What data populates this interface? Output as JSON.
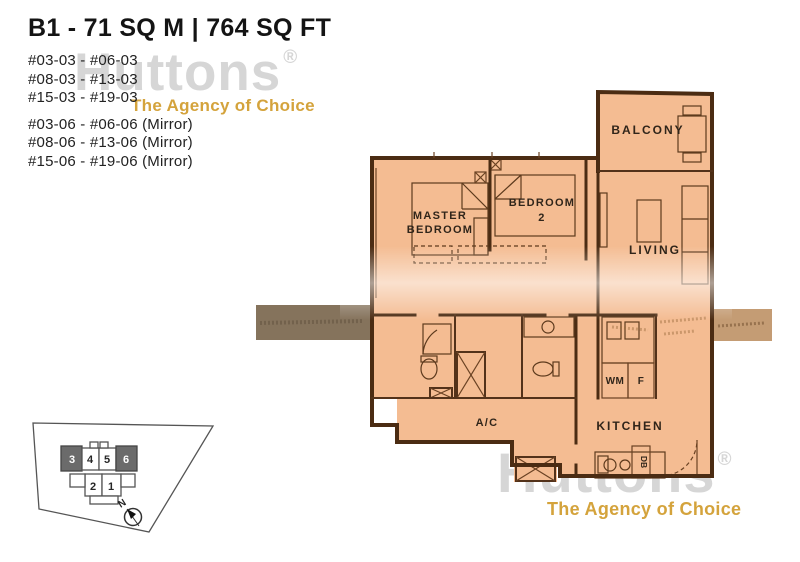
{
  "header": {
    "title": "B1 - 71 SQ M | 764 SQ FT",
    "stack_03_lines": [
      "#03-03 - #06-03",
      "#08-03 - #13-03",
      "#15-03 - #19-03"
    ],
    "stack_06_lines": [
      "#03-06 - #06-06 (Mirror)",
      "#08-06 - #13-06 (Mirror)",
      "#15-06 - #19-06 (Mirror)"
    ]
  },
  "watermark": {
    "brand": "Huttons",
    "registered": "®",
    "tagline": "The Agency of Choice",
    "gray": "#d6d6d6",
    "gold": "#d4a33c"
  },
  "floorplan": {
    "rooms": {
      "balcony": "BALCONY",
      "living": "LIVING",
      "master_line1": "MASTER",
      "master_line2": "BEDROOM",
      "bedroom2_line1": "BEDROOM",
      "bedroom2_line2": "2",
      "ac": "A/C",
      "kitchen": "KITCHEN"
    },
    "appliances": {
      "wm": "WM",
      "fridge": "F",
      "db": "DB"
    },
    "colors": {
      "fill": "#f4bc92",
      "wall": "#4b2c13",
      "label": "#30251a"
    }
  },
  "siteplan": {
    "units": [
      {
        "no": "3",
        "highlighted": true
      },
      {
        "no": "4",
        "highlighted": false
      },
      {
        "no": "5",
        "highlighted": false
      },
      {
        "no": "6",
        "highlighted": true
      },
      {
        "no": "2",
        "highlighted": false
      },
      {
        "no": "1",
        "highlighted": false
      }
    ],
    "north_label": "N",
    "highlight_color": "#6b6b6b"
  }
}
